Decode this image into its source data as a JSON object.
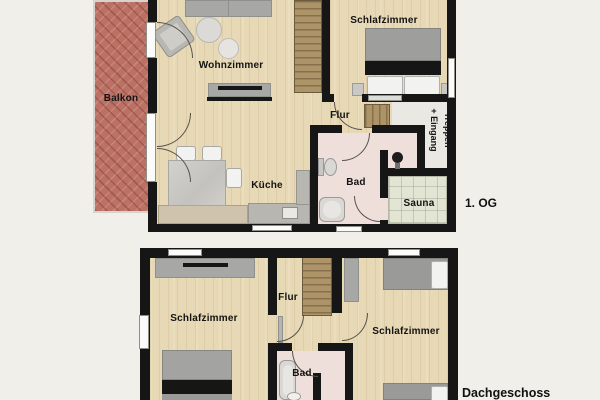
{
  "colors": {
    "bg": "#f0efea",
    "wall": "#161616",
    "wood": "#e8d9b6",
    "balcony": "#bc7164",
    "bath": "#eedfda",
    "sauna": "#e2e5d4",
    "hall": "#e9e8e3",
    "stairsbase": "#ad9468",
    "stairsstripe": "#86704c",
    "furngray": "#a7a7a5",
    "furnlight": "#c9c8c4",
    "counterbeige": "#cfc3ad",
    "countergray": "#b8b6b0",
    "whitefurn": "#f2f2f0",
    "labelink": "#141414"
  },
  "upper_floor": {
    "floor_label": "1. OG",
    "rooms": {
      "balkon": "Balkon",
      "wohnzimmer": "Wohnzimmer",
      "schlafzimmer": "Schlafzimmer",
      "flur": "Flur",
      "kueche": "Küche",
      "bad": "Bad",
      "sauna": "Sauna",
      "treppen_line1": "Treppen",
      "treppen_line2": "+ Eingang"
    }
  },
  "lower_floor": {
    "floor_label": "Dachgeschoss",
    "rooms": {
      "schlafzimmer_left": "Schlafzimmer",
      "flur": "Flur",
      "bad": "Bad",
      "schlafzimmer_right": "Schlafzimmer"
    }
  }
}
